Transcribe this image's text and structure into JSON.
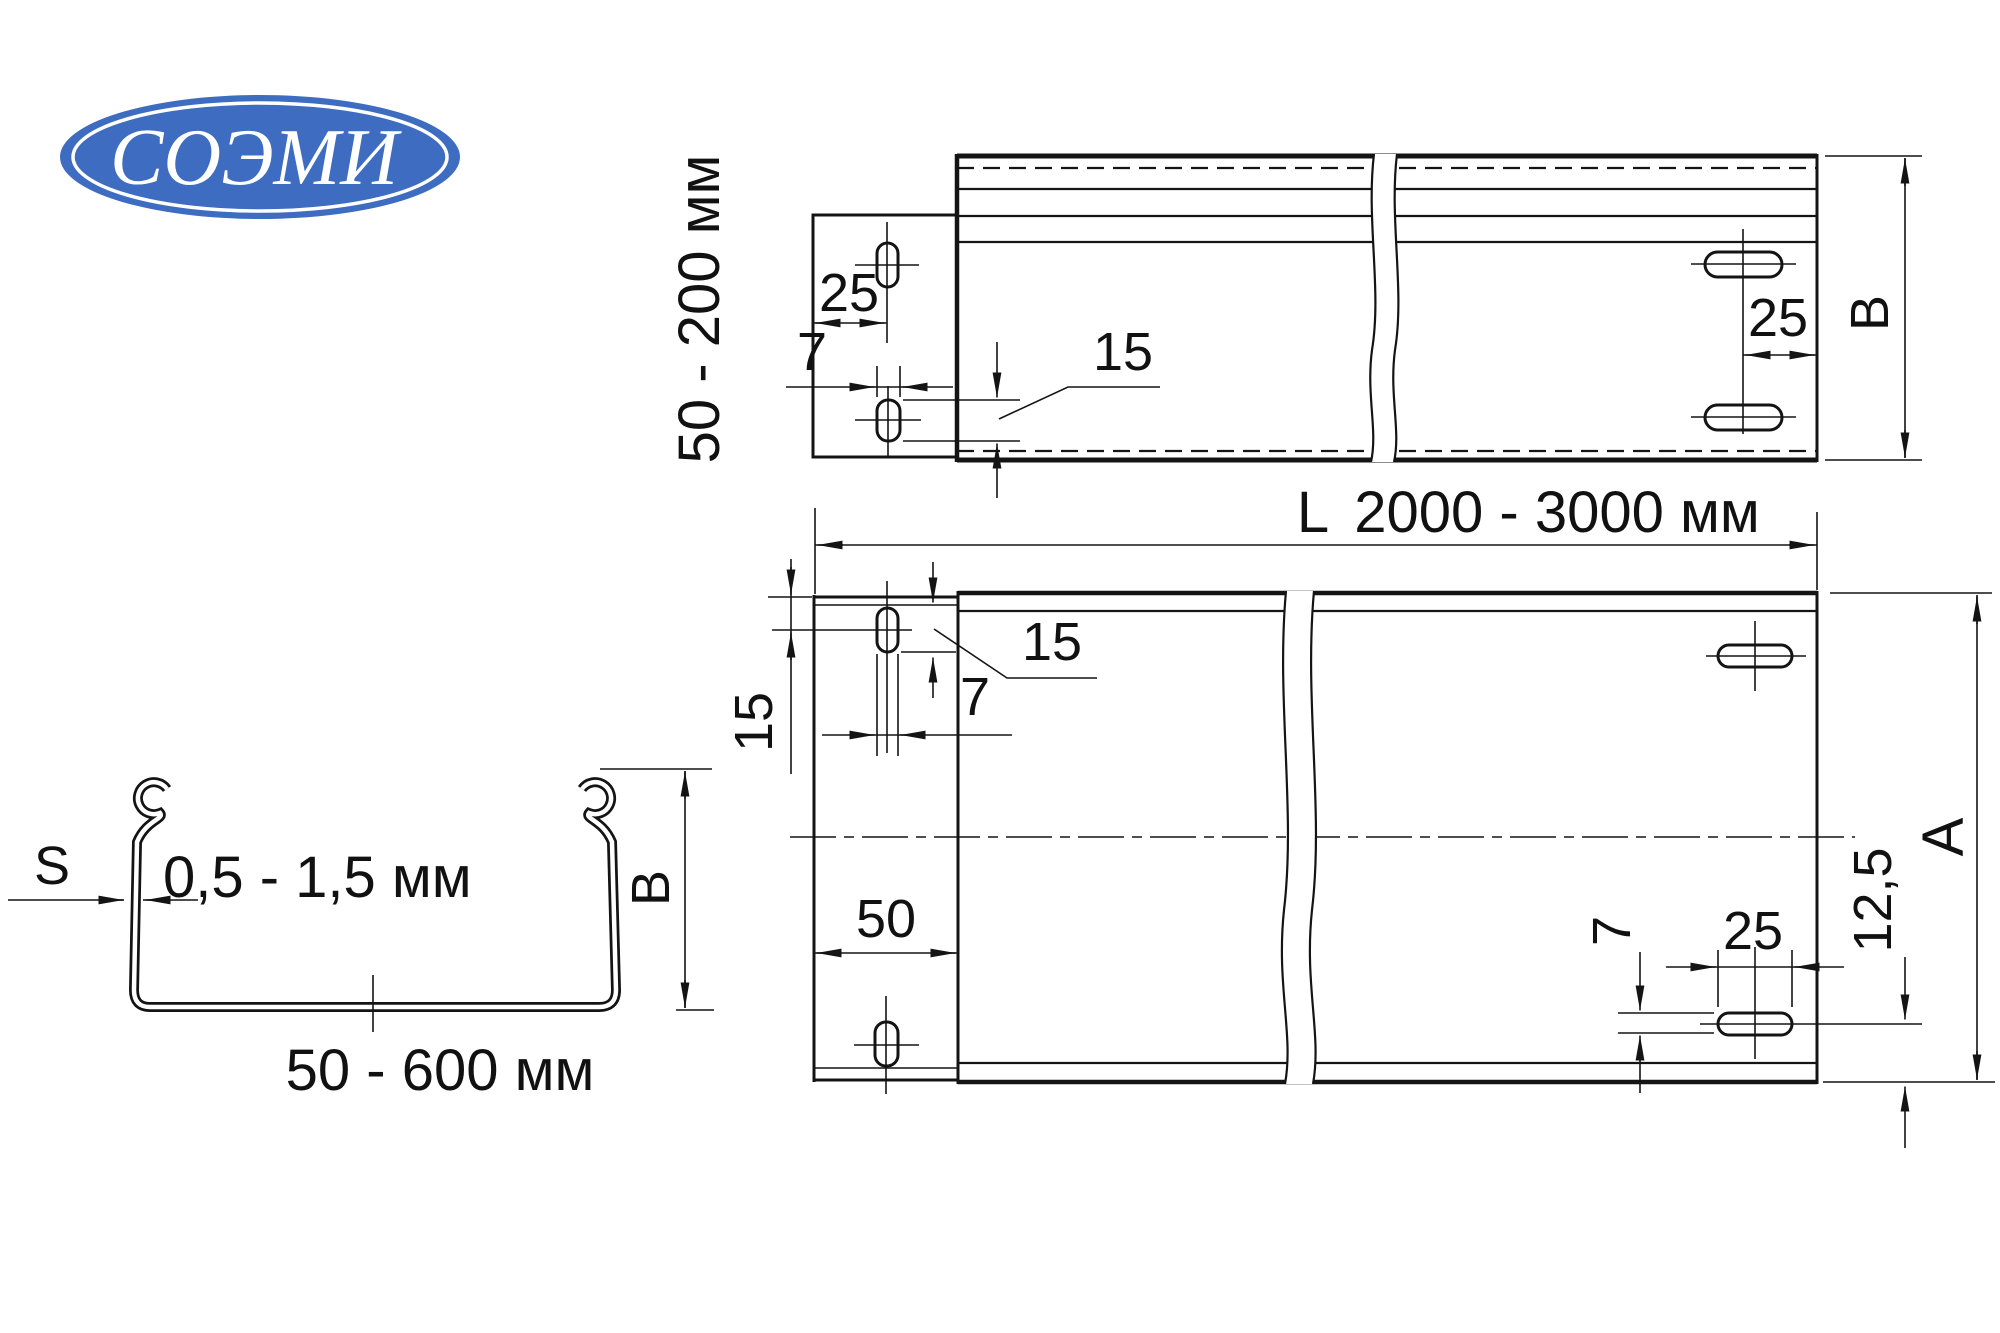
{
  "logo": {
    "text": "СОЭМИ",
    "color": "#3d6cc0"
  },
  "top_view": {
    "height_range": "50 - 200 мм",
    "dim_25_left": "25",
    "dim_7": "7",
    "dim_15": "15",
    "dim_25_right": "25",
    "dim_b": "B"
  },
  "length_dim": {
    "label": "L",
    "range": "2000 - 3000 мм"
  },
  "plan_view": {
    "dim_15_left": "15",
    "dim_15_leader": "15",
    "dim_7_top": "7",
    "dim_50": "50",
    "dim_7_right": "7",
    "dim_25": "25",
    "dim_12_5": "12,5",
    "dim_a": "A"
  },
  "section_view": {
    "thickness_label": "S",
    "thickness_range": "0,5 - 1,5 мм",
    "dim_b": "B",
    "width_range": "50 - 600 мм"
  }
}
